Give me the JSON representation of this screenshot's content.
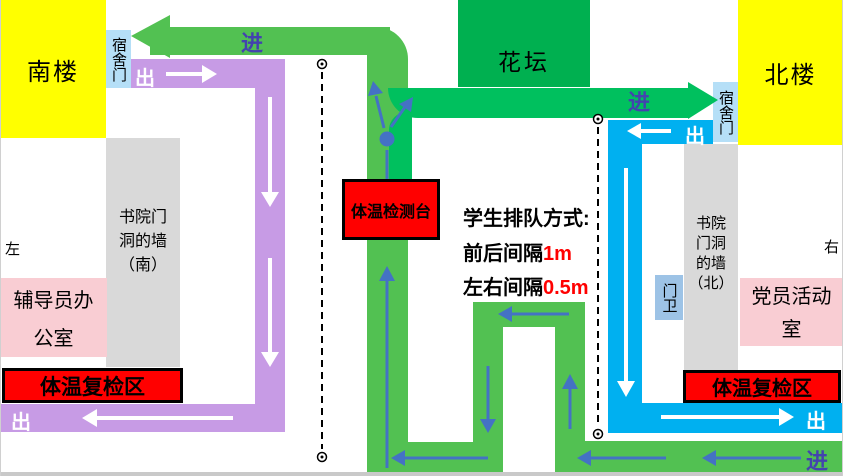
{
  "buildings": {
    "south": "南楼",
    "north": "北楼",
    "flowerbed": "花坛"
  },
  "gates": {
    "dorm": "宿舍门"
  },
  "labels": {
    "enter": "进",
    "exit": "出",
    "left": "左",
    "right": "右",
    "guard": "门卫"
  },
  "stations": {
    "temp_check": "体温检测台",
    "recheck": "体温复检区"
  },
  "rooms": {
    "counselor": [
      "辅导员办",
      "公室"
    ],
    "party": [
      "党员活动",
      "室"
    ]
  },
  "walls": {
    "south": [
      "书院门",
      "洞的墙",
      "（南）"
    ],
    "north": [
      "书院",
      "门洞",
      "的墙",
      "（北）"
    ]
  },
  "queue_note": {
    "title": "学生排队方式:",
    "rows": [
      {
        "label": "前后间隔",
        "value": "1m"
      },
      {
        "label": "左右间隔",
        "value": "0.5m"
      }
    ]
  },
  "colors": {
    "building": "#FFFF00",
    "flowerbed": "#00B050",
    "entry_path": "#52C152",
    "entry_path_north": "#00C05E",
    "exit_path_south": "#C79BE5",
    "exit_path_north": "#00B0F0",
    "station": "#FF0000",
    "room": "#F9CDD3",
    "wall": "#D9D9D9",
    "gate": "#B5DFF7",
    "guard_post": "#9DC3E6",
    "flow_arrow": "#4472C4",
    "enter_text": "#4343AE",
    "note_highlight": "#FF0000"
  }
}
